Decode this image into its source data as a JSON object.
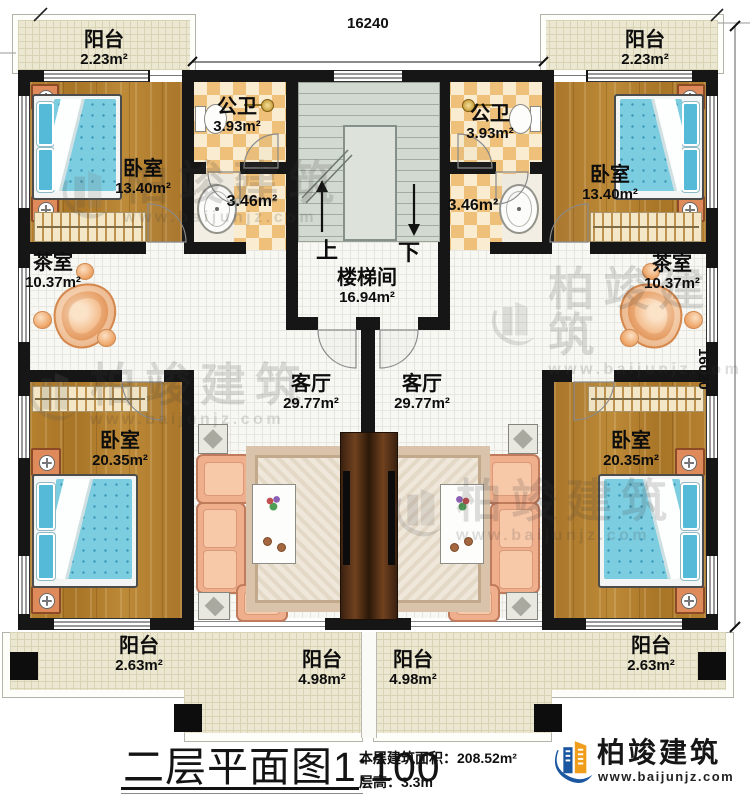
{
  "dimensions": {
    "top": "16240",
    "right": "16020"
  },
  "watermark": {
    "brand": "柏竣建筑",
    "url": "www.baijunjz.com"
  },
  "logo": {
    "brand": "柏竣建筑",
    "url": "www.baijunjz.com"
  },
  "title": {
    "main": "二层平面图",
    "scale": "1:100",
    "area_label": "本层建筑面积：",
    "area_value": "208.52m²",
    "height_label": "层高：",
    "height_value": "3.3m"
  },
  "stairs": {
    "up": "上",
    "down": "下"
  },
  "labels": {
    "balcony_tl": {
      "name": "阳台",
      "area": "2.23m²"
    },
    "balcony_tr": {
      "name": "阳台",
      "area": "2.23m²"
    },
    "bedroom_tl": {
      "name": "卧室",
      "area": "13.40m²"
    },
    "bedroom_tr": {
      "name": "卧室",
      "area": "13.40m²"
    },
    "bath_l": {
      "name": "公卫",
      "area": "3.93m²"
    },
    "bath_r": {
      "name": "公卫",
      "area": "3.93m²"
    },
    "wash_l": {
      "area": "3.46m²"
    },
    "wash_r": {
      "area": "3.46m²"
    },
    "stairwell": {
      "name": "楼梯间",
      "area": "16.94m²"
    },
    "tea_l": {
      "name": "茶室",
      "area": "10.37m²"
    },
    "tea_r": {
      "name": "茶室",
      "area": "10.37m²"
    },
    "living_l": {
      "name": "客厅",
      "area": "29.77m²"
    },
    "living_r": {
      "name": "客厅",
      "area": "29.77m²"
    },
    "bedroom_bl": {
      "name": "卧室",
      "area": "20.35m²"
    },
    "bedroom_br": {
      "name": "卧室",
      "area": "20.35m²"
    },
    "balcony_bl": {
      "name": "阳台",
      "area": "2.63m²"
    },
    "balcony_bml": {
      "name": "阳台",
      "area": "4.98m²"
    },
    "balcony_bmr": {
      "name": "阳台",
      "area": "4.98m²"
    },
    "balcony_br": {
      "name": "阳台",
      "area": "2.63m²"
    }
  },
  "colors": {
    "wall": "#161616",
    "wood": "#b07c2d",
    "brand_blue": "#1a57a0",
    "brand_orange": "#f09d1c"
  }
}
